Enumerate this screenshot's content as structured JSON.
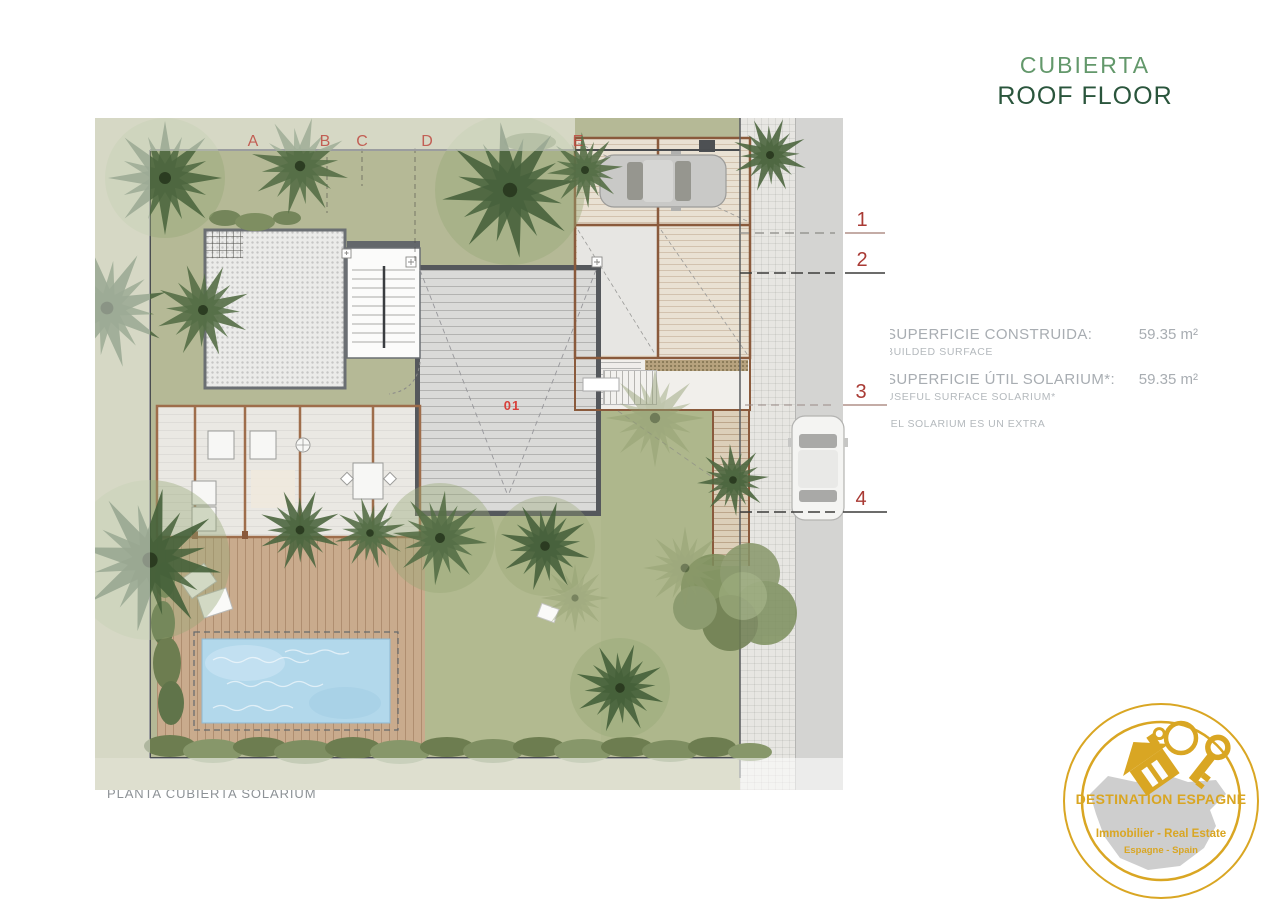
{
  "header": {
    "title_es": "CUBIERTA",
    "title_en": "ROOF FLOOR"
  },
  "grid": {
    "letters": [
      "A",
      "B",
      "C",
      "D",
      "E"
    ],
    "numbers": [
      "1",
      "2",
      "3",
      "4"
    ]
  },
  "plan": {
    "unit_label": "01",
    "caption": "PLANTA CUBIERTA SOLÁRIUM"
  },
  "measurements": {
    "rows": [
      {
        "label_es": "SUPERFICIE CONSTRUIDA:",
        "label_en": "BUILDED SURFACE",
        "value": "59.35 m²"
      },
      {
        "label_es": "SUPERFICIE ÚTIL SOLARIUM*:",
        "label_en": "USEFUL SURFACE SOLARIUM*",
        "value": "59.35 m²"
      }
    ],
    "footnote": "*EL SOLARIUM ES UN EXTRA"
  },
  "logo": {
    "name": "DESTINATION ESPAGNE",
    "tagline": "Immobilier - Real Estate",
    "subtitle": "Espagne - Spain"
  },
  "colors": {
    "title_light_green": "#63986b",
    "title_dark_green": "#2a553c",
    "marker_red": "#a93a34",
    "logo_gold": "#d9a623",
    "pool_blue": "#b2d8eb"
  }
}
